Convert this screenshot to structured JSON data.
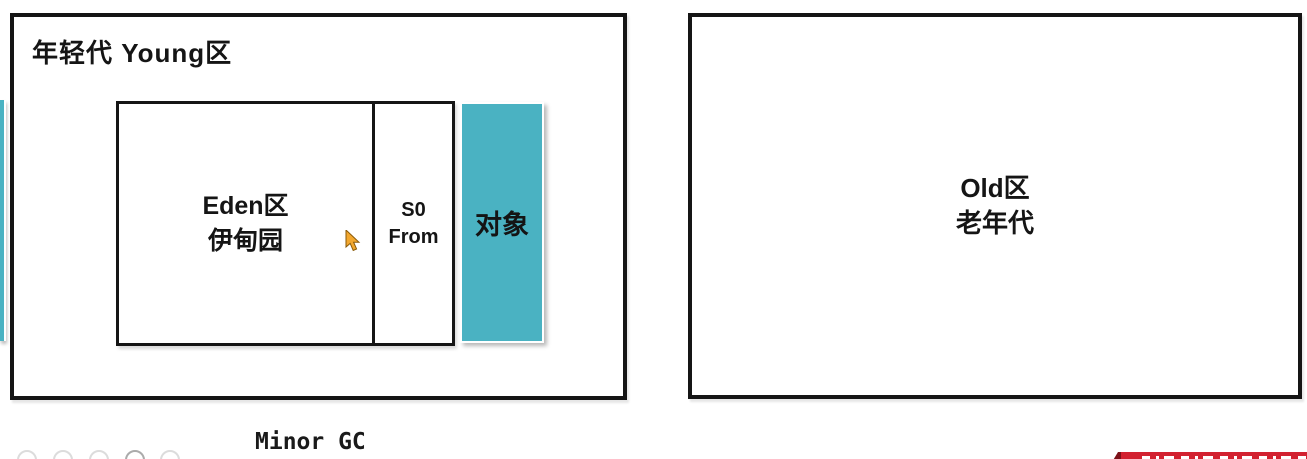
{
  "diagram": {
    "young": {
      "title": "年轻代 Young区",
      "eden": {
        "line1": "Eden区",
        "line2": "伊甸园"
      },
      "survivor": {
        "line1": "S0",
        "line2": "From"
      },
      "object_box": {
        "label": "对象"
      }
    },
    "old": {
      "line1": "Old区",
      "line2": "老年代"
    },
    "gc_label": "Minor GC"
  },
  "colors": {
    "teal": "#4ab2c2",
    "border_black": "#151515",
    "ribbon_red": "#d22130",
    "ribbon_fold_dark": "#7e1119",
    "cursor_orange": "#f2a72e",
    "circle_gray": "#dcdcdc"
  },
  "decor": {
    "bottom_circles": {
      "lefts": [
        17,
        53,
        89,
        125,
        160
      ],
      "emphasized_index": 3
    }
  }
}
